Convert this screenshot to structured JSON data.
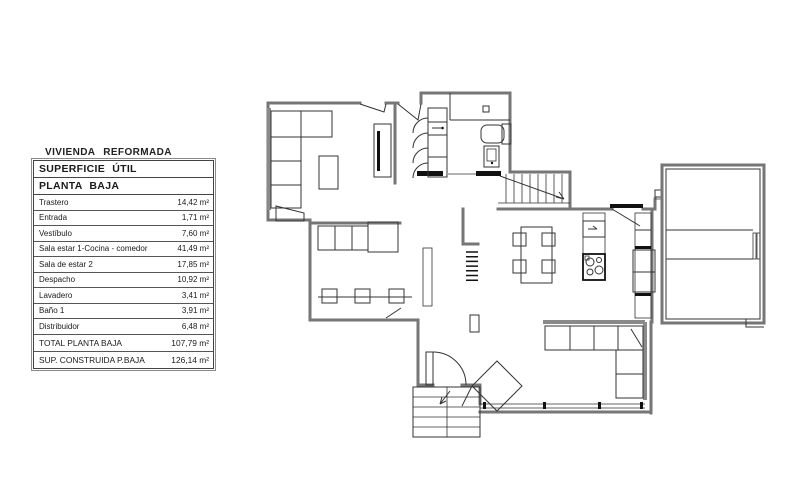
{
  "legend": {
    "title": "VIVIENDA  REFORMADA",
    "headers": [
      "SUPERFICIE  ÚTIL",
      "PLANTA  BAJA"
    ],
    "rows": [
      {
        "label": "Trastero",
        "value": "14,42 m²"
      },
      {
        "label": "Entrada",
        "value": "1,71 m²"
      },
      {
        "label": "Vestíbulo",
        "value": "7,60 m²"
      },
      {
        "label": "Sala estar 1-Cocina - comedor",
        "value": "41,49 m²"
      },
      {
        "label": "Sala de estar 2",
        "value": "17,85 m²"
      },
      {
        "label": "Despacho",
        "value": "10,92 m²"
      },
      {
        "label": "Lavadero",
        "value": "3,41 m²"
      },
      {
        "label": "Baño 1",
        "value": "3,91 m²"
      },
      {
        "label": "Distribuidor",
        "value": "6,48 m²"
      }
    ],
    "totals": [
      {
        "label": "TOTAL PLANTA BAJA",
        "value": "107,79 m²"
      },
      {
        "label": "SUP. CONSTRUIDA P.BAJA",
        "value": "126,14 m²"
      }
    ]
  },
  "floorplan": {
    "type": "architectural-ground-floor-plan",
    "colors": {
      "wall": "#767676",
      "line": "#333333",
      "threshold": "#111111",
      "background": "#ffffff"
    },
    "features": [
      "sectional-sofa",
      "coffee-table",
      "tv-unit",
      "entry-double-doors",
      "closet-folding-doors",
      "bathroom-tub",
      "toilet",
      "interior-staircase",
      "dining-table-4-chairs",
      "kitchen-sink-unit",
      "cooktop",
      "fridge-counter",
      "storage-room",
      "l-shaped-sofa",
      "rotated-armchair",
      "office-desk-3-chairs",
      "office-cabinets",
      "radiator-mark",
      "window-wall",
      "exterior-steps"
    ]
  }
}
